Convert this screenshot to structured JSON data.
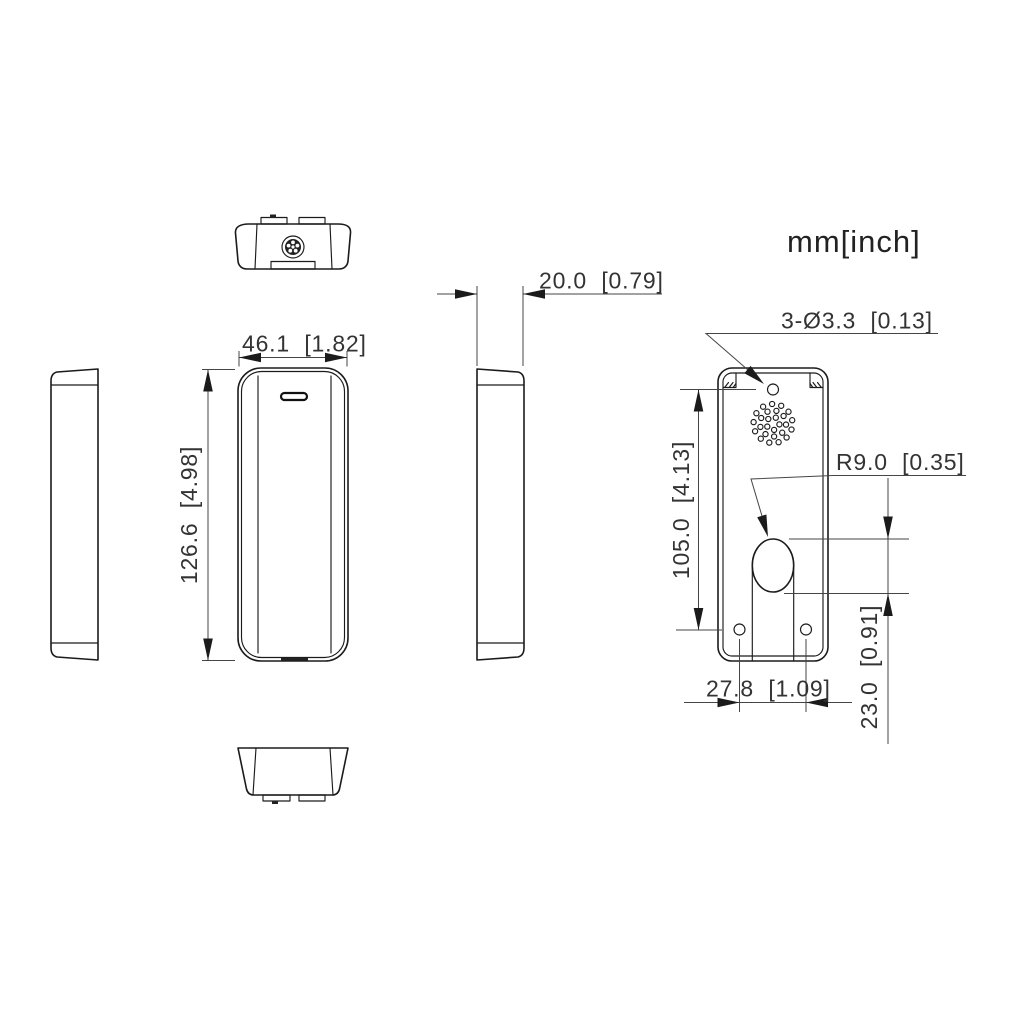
{
  "drawing": {
    "units_label": "mm[inch]",
    "dimensions": {
      "depth": "20.0  [0.79]",
      "width": "46.1  [1.82]",
      "height": "126.6  [4.98]",
      "mounting_holes_note": "3-Ø3.3  [0.13]",
      "hole_spacing_vertical": "105.0  [4.13]",
      "cable_hole_radius": "R9.0  [0.35]",
      "cable_hole_height": "23.0  [0.91]",
      "hole_spacing_horizontal": "27.8  [1.09]"
    }
  }
}
